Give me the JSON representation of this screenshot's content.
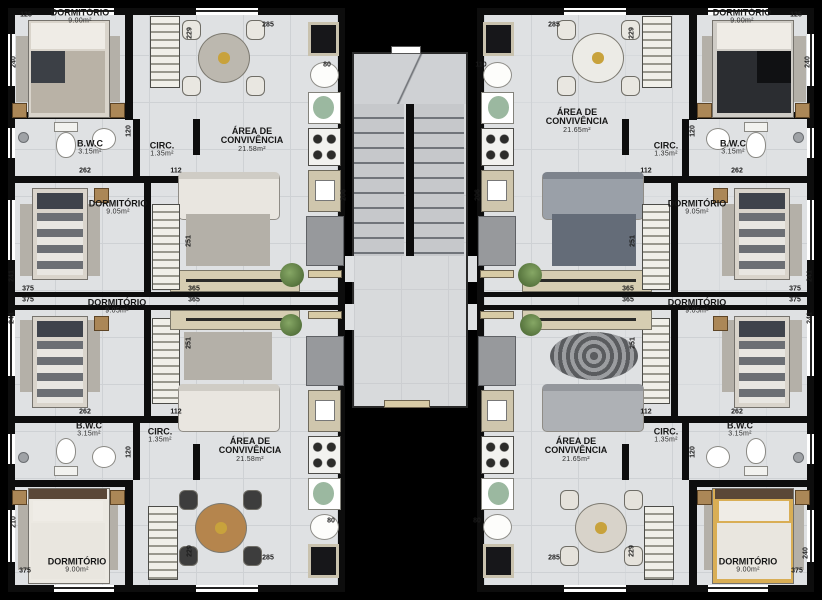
{
  "plan": {
    "left_top_apartment": {
      "dormitorio_corner": {
        "name": "DORMITÓRIO",
        "area": "9.00m²"
      },
      "bwc": {
        "name": "B.W.C",
        "area": "3.15m²"
      },
      "circ": {
        "name": "CIRC.",
        "area": "1.35m²"
      },
      "convivencia": {
        "name": "ÁREA DE\nCONVIVÊNCIA",
        "area": "21.58m²"
      },
      "dormitorio_middle": {
        "name": "DORMITÓRIO",
        "area": "9.05m²"
      }
    },
    "left_bottom_apartment": {
      "dormitorio_middle": {
        "name": "DORMITÓRIO",
        "area": "9.05m²"
      },
      "bwc": {
        "name": "B.W.C",
        "area": "3.15m²"
      },
      "circ": {
        "name": "CIRC.",
        "area": "1.35m²"
      },
      "convivencia": {
        "name": "ÁREA DE\nCONVIVÊNCIA",
        "area": "21.58m²"
      },
      "dormitorio_corner": {
        "name": "DORMITÓRIO",
        "area": "9.00m²"
      }
    },
    "right_top_apartment": {
      "dormitorio_corner": {
        "name": "DORMITÓRIO",
        "area": "9.00m²"
      },
      "bwc": {
        "name": "B.W.C",
        "area": "3.15m²"
      },
      "circ": {
        "name": "CIRC.",
        "area": "1.35m²"
      },
      "convivencia": {
        "name": "ÁREA DE\nCONVIVÊNCIA",
        "area": "21.65m²"
      },
      "dormitorio_middle": {
        "name": "DORMITÓRIO",
        "area": "9.05m²"
      }
    },
    "right_bottom_apartment": {
      "dormitorio_middle": {
        "name": "DORMITÓRIO",
        "area": "9.05m²"
      },
      "bwc": {
        "name": "B.W.C",
        "area": "3.15m²"
      },
      "circ": {
        "name": "CIRC.",
        "area": "1.35m²"
      },
      "convivencia": {
        "name": "ÁREA DE\nCONVIVÊNCIA",
        "area": "21.65m²"
      },
      "dormitorio_corner": {
        "name": "DORMITÓRIO",
        "area": "9.00m²"
      }
    }
  },
  "dimensions_cm": {
    "v125": "125",
    "v240": "240",
    "v262": "262",
    "v120": "120",
    "v112": "112",
    "v285": "285",
    "v80": "80",
    "v110": "110",
    "v375": "375",
    "v241": "241",
    "v251": "251",
    "v365": "365",
    "v210": "210",
    "v229": "229",
    "v206": "206"
  },
  "colors": {
    "background": "#000000",
    "floor": "#dfe1e3",
    "wall": "#0d0d0d",
    "green_sink": "#9bb8a0",
    "wood_table": "#b5854d",
    "yellow_bed": "#d9ae55"
  }
}
